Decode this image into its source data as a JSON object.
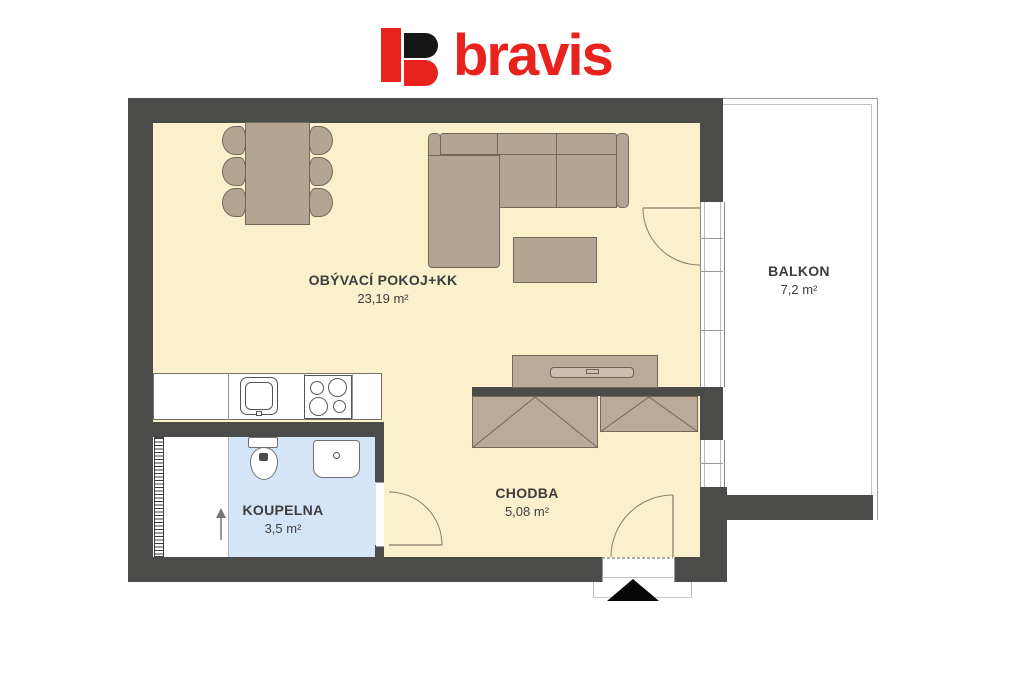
{
  "brand": {
    "name": "bravis",
    "colors": {
      "red": "#e8231d",
      "black": "#161616"
    }
  },
  "plan": {
    "colors": {
      "wall": "#4b4b49",
      "floor": "#faf0cc",
      "bathroom_floor": "#d3e5f7",
      "furniture": "#b4a593",
      "balcony_floor": "#ffffff",
      "label_text": "#3d3d3d"
    },
    "rooms": [
      {
        "id": "living",
        "name": "OBÝVACÍ POKOJ+KK",
        "area": "23,19 m²"
      },
      {
        "id": "balcony",
        "name": "BALKON",
        "area": "7,2 m²"
      },
      {
        "id": "bathroom",
        "name": "KOUPELNA",
        "area": "3,5 m²"
      },
      {
        "id": "hallway",
        "name": "CHODBA",
        "area": "5,08 m²"
      }
    ],
    "furniture_icons": [
      "dining-table",
      "dining-chair",
      "sofa",
      "chaise",
      "coffee-table",
      "tv-cabinet",
      "wardrobe",
      "kitchen-counter",
      "kitchen-sink",
      "hob",
      "toilet",
      "washbasin",
      "towel-radiator",
      "entrance-marker"
    ]
  }
}
